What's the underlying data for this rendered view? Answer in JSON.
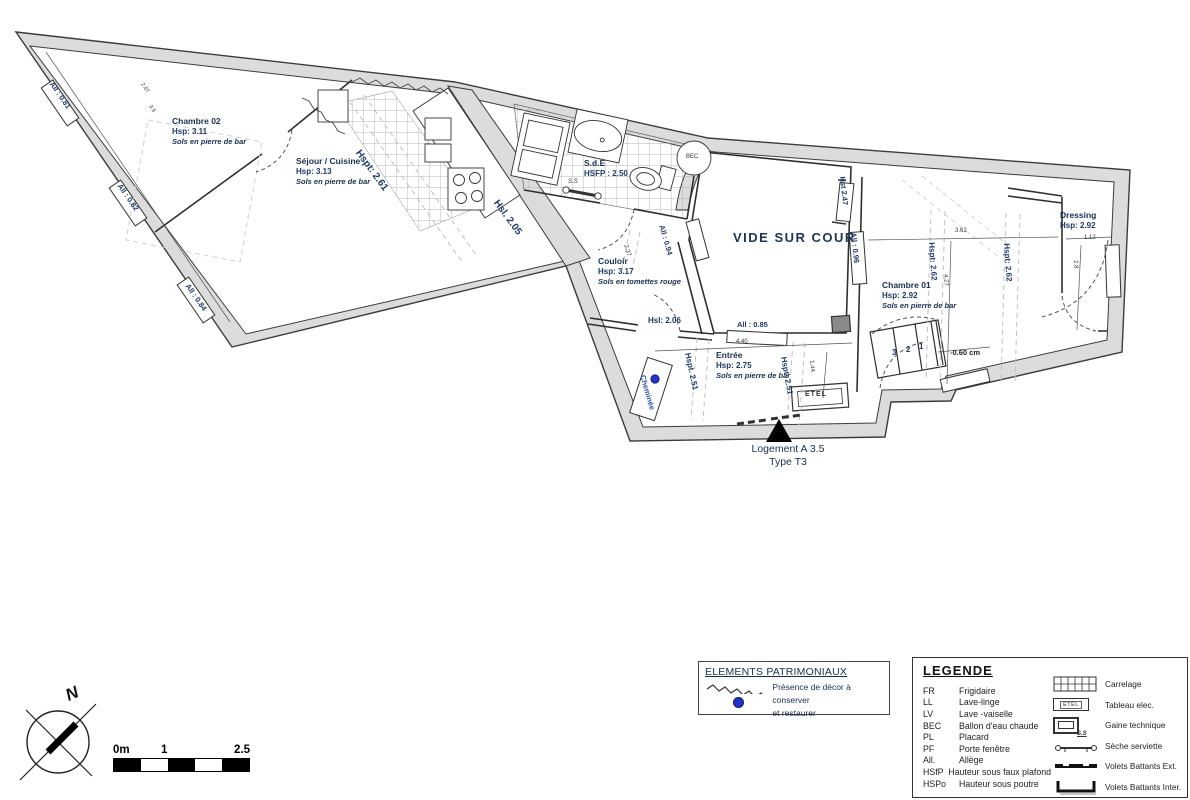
{
  "plan": {
    "courtyard": "VIDE SUR COUR",
    "rooms": {
      "chambre02": {
        "name": "Chambre 02",
        "height": "Hsp: 3.11",
        "floor": "Sols en pierre de bar"
      },
      "sejour": {
        "name": "Séjour / Cuisine",
        "height": "Hsp: 3.13",
        "floor": "Sols en pierre de bar"
      },
      "sde": {
        "name": "S.d.E",
        "height": "HSFP : 2.50"
      },
      "couloir": {
        "name": "Couloir",
        "height": "Hsp: 3.17",
        "floor": "Sols en tomettes rouge"
      },
      "entree": {
        "name": "Entrée",
        "height": "Hsp: 2.75",
        "floor": "Sols en pierre de bar"
      },
      "chambre01": {
        "name": "Chambre 01",
        "height": "Hsp: 2.92",
        "floor": "Sols en pierre de bar"
      },
      "dressing": {
        "name": "Dressing",
        "height": "Hsp: 2.92"
      }
    },
    "annotations": {
      "hspt_261": "Hspt: 2.61",
      "hsl_205": "Hsl. 2.05",
      "hst_247": "Hst 2.47",
      "hsl_206": "Hsl: 2.06",
      "all_081": "All : 0.81",
      "all_082": "All : 0.82",
      "all_084": "All : 0.84",
      "all_094": "All : 0.94",
      "all_096": "All : 0.96",
      "all_085": "All : 0.85",
      "hspt_251a": "Hspt. 2.51",
      "hspt_251b": "Hspt: 2.51",
      "hspt_262a": "Hspt: 2.62",
      "hspt_262b": "Hspt: 2.62",
      "dim_362": "3.62",
      "dim_112": "1.12",
      "dim_427": "4.27",
      "dim_28": "2.8",
      "dim_060": "-0.60 cm",
      "dim_440": "4.40",
      "dim_144": "1.44",
      "dim_237": "2.37",
      "dim_267": "2.67",
      "dim_39": "3.9",
      "cheminee": "Cheminée",
      "bec": "BEC",
      "etel": "ETEL",
      "ss": "S.S",
      "stair_1": "1",
      "stair_2": "2",
      "stair_3": "3"
    },
    "title": {
      "line1": "Logement A 3.5",
      "line2": "Type T3"
    }
  },
  "patrimonial": {
    "title": "ELEMENTS PATRIMONIAUX",
    "desc_line1": "Présence de décor à conserver",
    "desc_line2": "et restaurer"
  },
  "legend": {
    "title": "LEGENDE",
    "abbreviations": [
      {
        "abbr": "FR",
        "label": "Frigidaire"
      },
      {
        "abbr": "LL",
        "label": "Lave-linge"
      },
      {
        "abbr": "LV",
        "label": "Lave -vaiselle"
      },
      {
        "abbr": "BEC",
        "label": "Ballon d'eau chaude"
      },
      {
        "abbr": "PL",
        "label": "Placard"
      },
      {
        "abbr": "PF",
        "label": "Porte fenêtre"
      },
      {
        "abbr": "All.",
        "label": "Allège"
      },
      {
        "abbr": "HSfP",
        "label": "Hauteur sous faux plafond"
      },
      {
        "abbr": "HSPo",
        "label": "Hauteur sous poutre"
      }
    ],
    "symbols": [
      {
        "icon": "carrelage-grid",
        "label": "Carrelage"
      },
      {
        "icon": "tableau-elec",
        "label": "Tableau elec.",
        "icon_text": "ETEL"
      },
      {
        "icon": "gaine-technique",
        "label": "Gaine technique"
      },
      {
        "icon": "seche-serviette",
        "label": "Sèche serviette",
        "icon_text": "S.S"
      },
      {
        "icon": "volets-ext",
        "label": "Volets Battants Ext."
      },
      {
        "icon": "volets-inter",
        "label": "Volets Battants Inter."
      }
    ]
  },
  "scalebar": {
    "label_0": "0m",
    "label_1": "1",
    "label_2": "2.5"
  },
  "compass": {
    "label": "N"
  },
  "colors": {
    "wall_grey": "#dcdcdc",
    "annotation_blue": "#1c3a66",
    "accent_blue": "#2233cc"
  }
}
